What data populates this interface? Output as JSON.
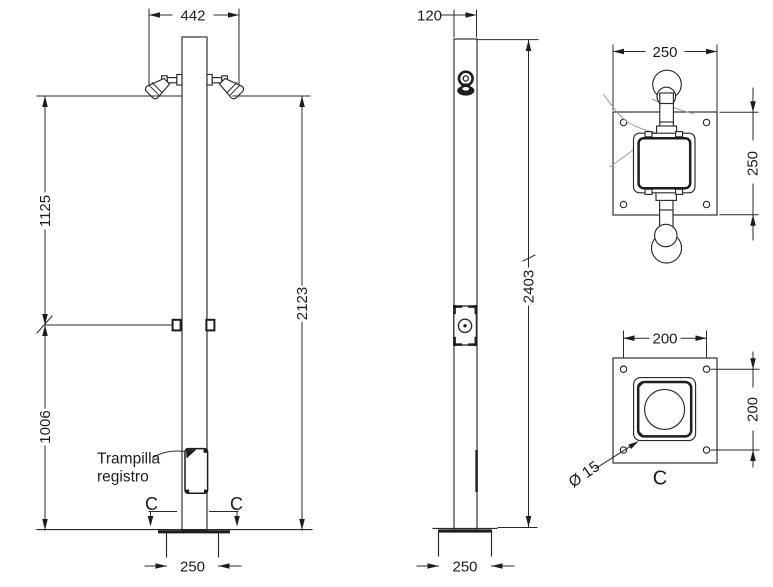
{
  "views": {
    "front": {
      "dim_width": "442",
      "dim_upper_height": "1125",
      "dim_lower_height": "1006",
      "dim_total_height": "2123",
      "dim_base_width": "250",
      "label_trapdoor_line1": "Trampilla",
      "label_trapdoor_line2": "registro",
      "section_marker_left": "C",
      "section_marker_right": "C"
    },
    "side": {
      "dim_width": "120",
      "dim_total_height": "2403",
      "dim_base_width": "250"
    },
    "plan": {
      "dim_width": "250",
      "dim_height": "250"
    },
    "section": {
      "dim_hole_spacing_x": "200",
      "dim_hole_spacing_y": "200",
      "label_hole_diameter": "Ø 15",
      "label_section": "C"
    }
  },
  "colors": {
    "line": "#2a2a2a",
    "background": "#ffffff",
    "sketch": "#9d9d9d"
  }
}
